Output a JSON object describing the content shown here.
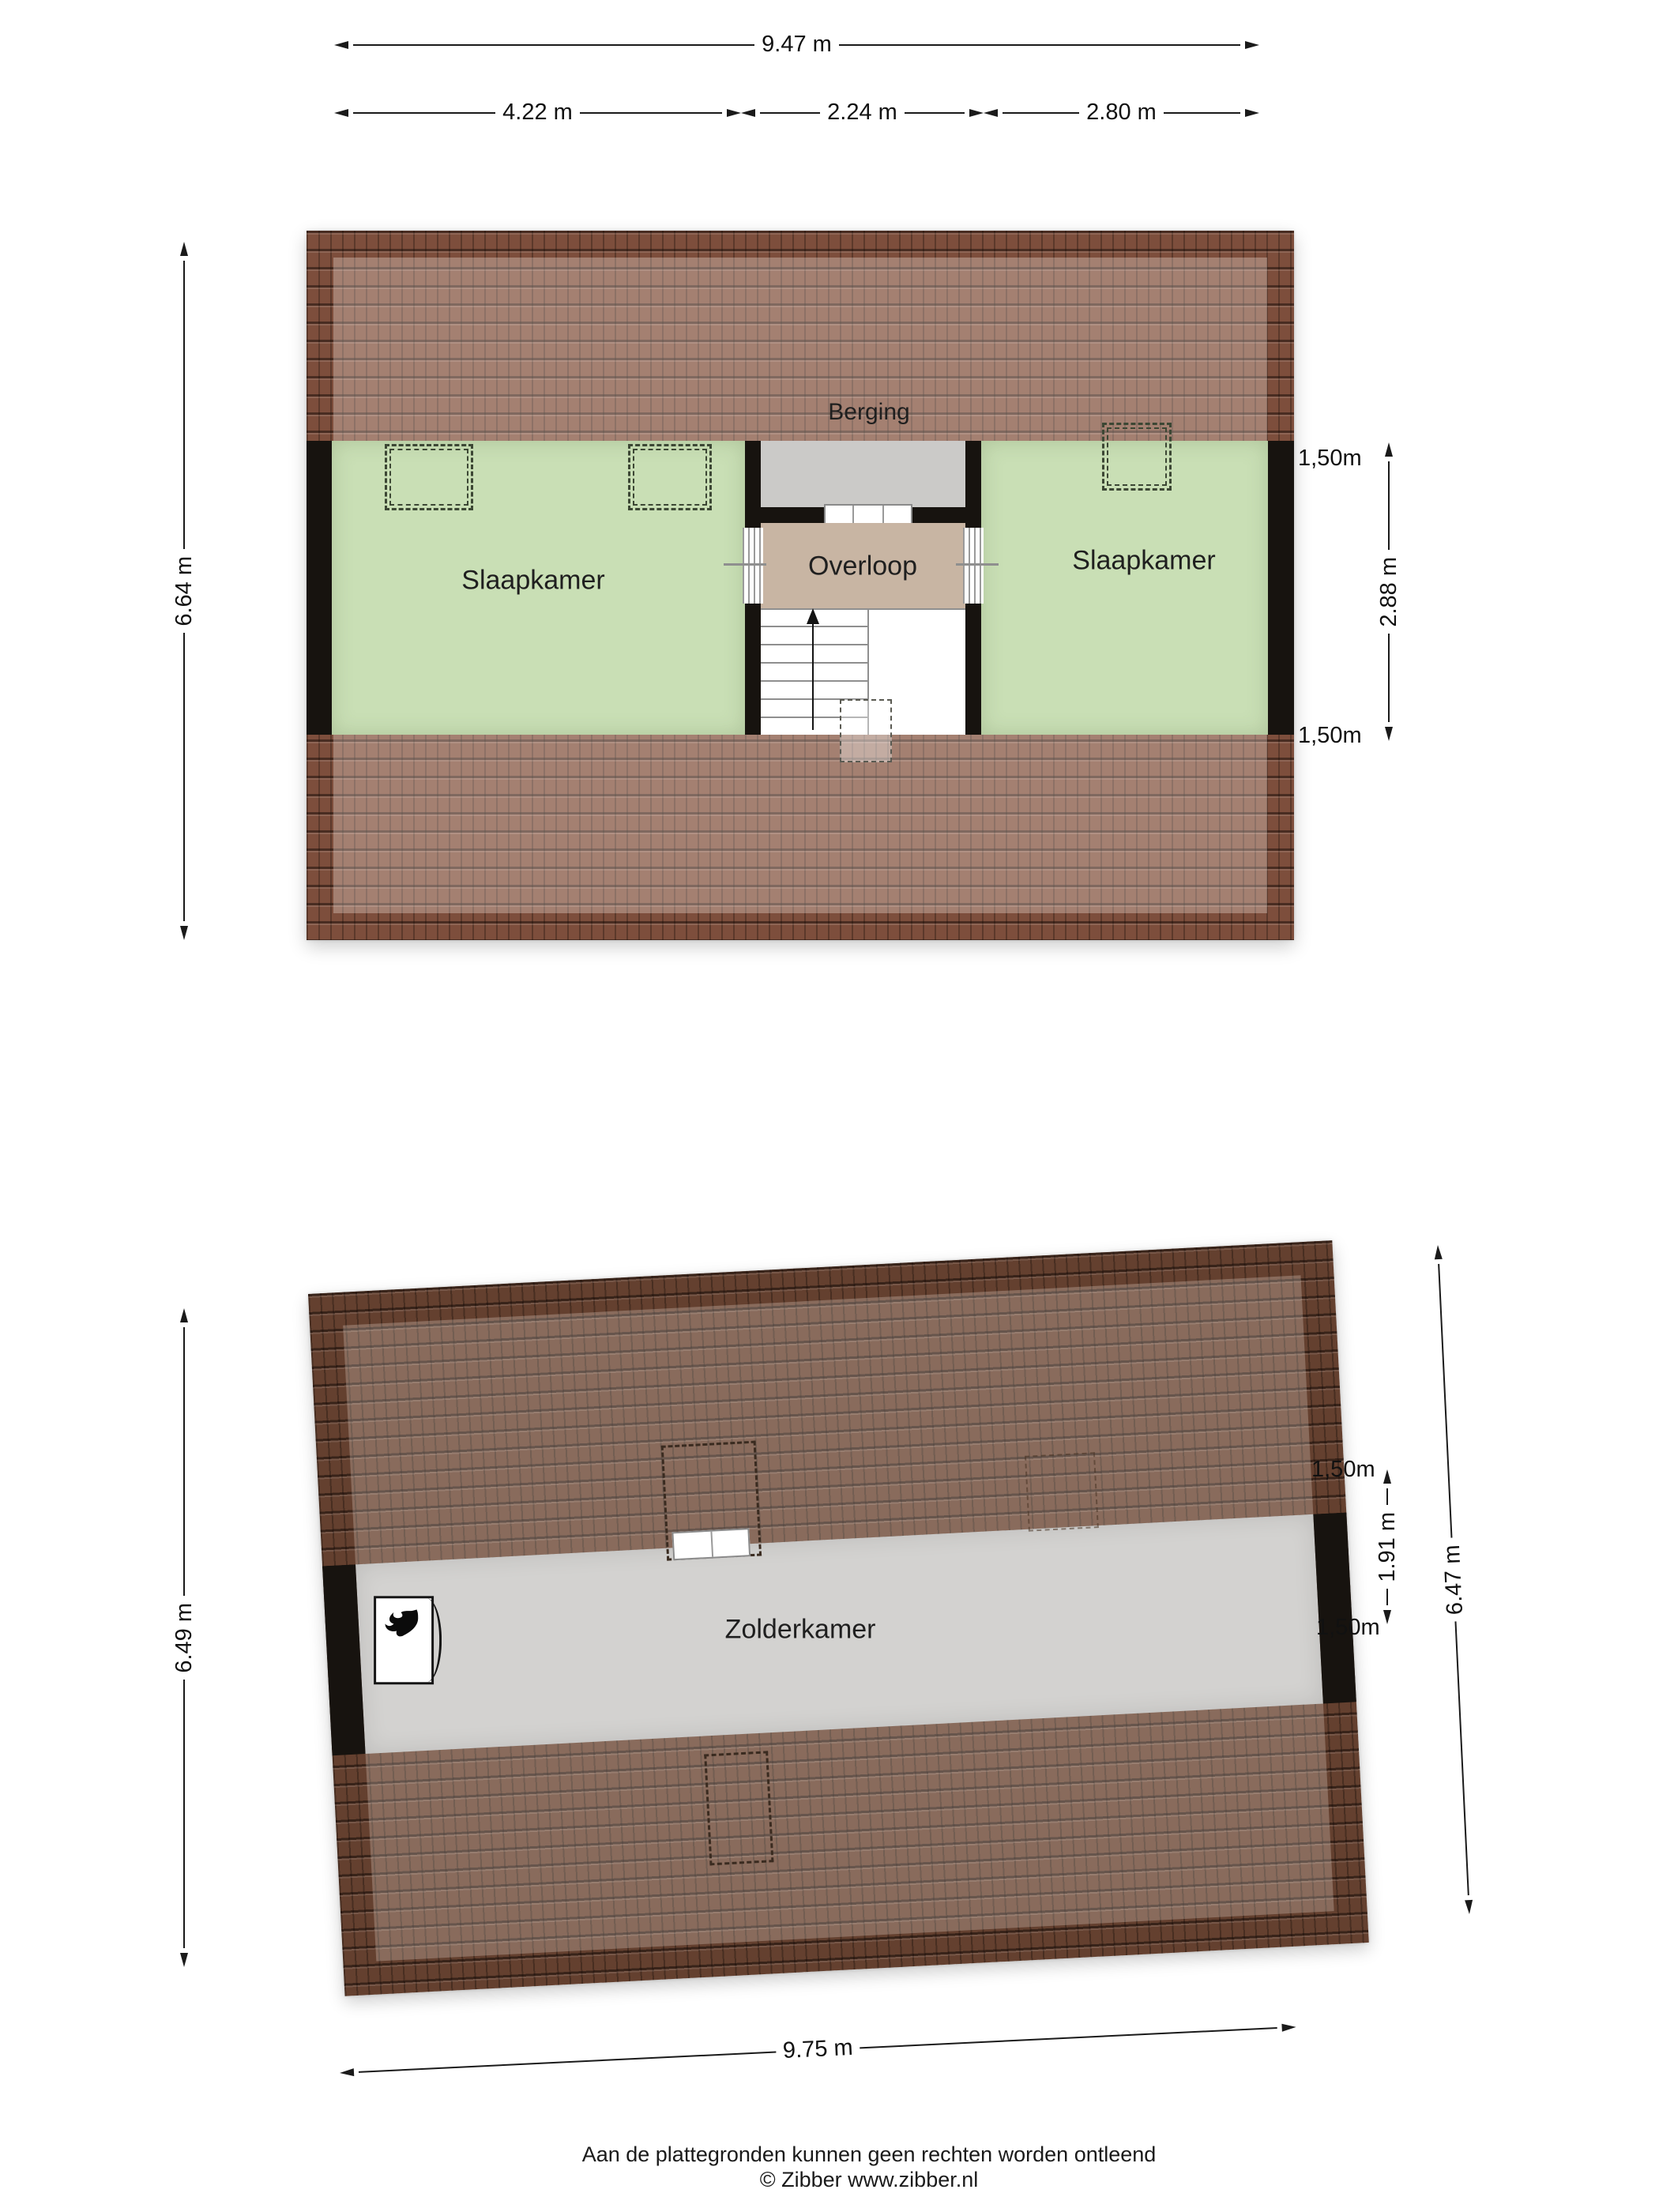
{
  "floor1": {
    "rooms": {
      "bedroom_left": "Slaapkamer",
      "landing": "Overloop",
      "bedroom_right": "Slaapkamer",
      "storage": "Berging"
    },
    "dims": {
      "total": "9.47 m",
      "seg_left": "4.22 m",
      "seg_mid": "2.24 m",
      "seg_right": "2.80 m",
      "side": "6.64 m",
      "inner": "2.88 m",
      "clear_top": "1,50m",
      "clear_bottom": "1,50m"
    }
  },
  "floor2": {
    "rooms": {
      "attic": "Zolderkamer"
    },
    "dims": {
      "width": "9.75 m",
      "side_left": "6.49 m",
      "side_right": "6.47 m",
      "inner": "1.91 m",
      "clear_top": "1,50m",
      "clear_bottom": "1,50m"
    }
  },
  "footer": {
    "line1": "Aan de plattegronden kunnen geen rechten worden ontleend",
    "line2": "© Zibber www.zibber.nl"
  },
  "colors": {
    "roof_floor1": "#7d4e3c",
    "roof_floor2": "#64402f",
    "room_green": "#c9dfb5",
    "landing_beige": "#c8b5a3",
    "storage_gray": "#cbcac8",
    "attic_gray": "#d3d2d0",
    "wall_black": "#17130f"
  }
}
